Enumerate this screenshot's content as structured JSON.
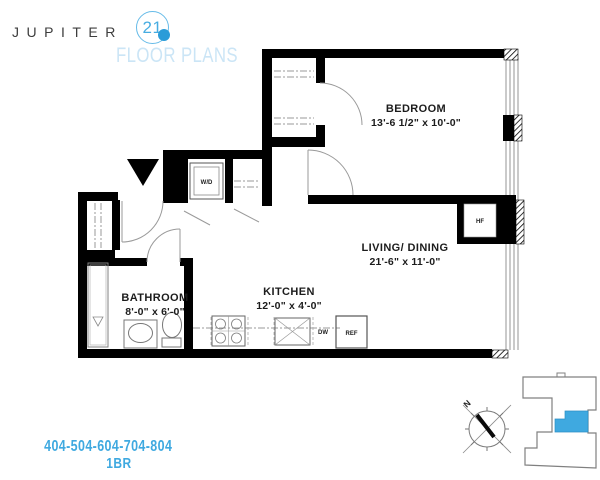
{
  "brand": {
    "name": "JUPITER",
    "number": "21",
    "tagline": "FLOOR PLANS"
  },
  "plan": {
    "rooms": {
      "bedroom": {
        "label": "BEDROOM",
        "dims": "13'-6 1/2\" x 10'-0\""
      },
      "living": {
        "label": "LIVING/ DINING",
        "dims": "21'-6\" x 11'-0\""
      },
      "kitchen": {
        "label": "KITCHEN",
        "dims": "12'-0\" x 4'-0\""
      },
      "bathroom": {
        "label": "BATHROOM",
        "dims": "8'-0\" x 6'-0\""
      }
    },
    "appliances": {
      "washer_dryer": "W/D",
      "dishwasher": "DW",
      "refrigerator": "REF",
      "fan_coil": "HF"
    }
  },
  "compass": {
    "north_label": "N"
  },
  "footer": {
    "unit_numbers": "404-504-604-704-804",
    "unit_type": "1BR"
  },
  "colors": {
    "accent_blue": "#3FA9E0",
    "logo_dot_blue": "#2B9CD8",
    "logo_circle_blue": "#66BBE8",
    "tagline_light_blue": "#CBE5F6",
    "unit_highlight": "#3FA9E0",
    "wall_black": "#000000"
  }
}
